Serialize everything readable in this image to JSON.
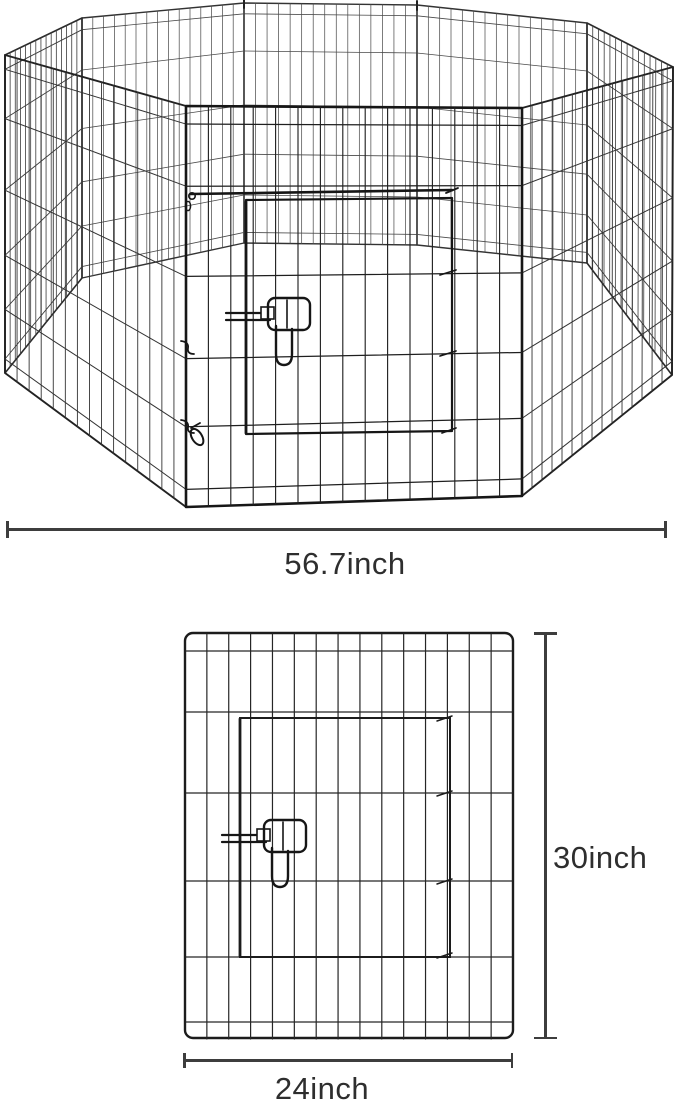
{
  "figure": {
    "kind": "product-dimension-diagram",
    "views": {
      "assembled": "octagonal-8-panel-wire-playpen-with-front-gate",
      "single_panel": "single-wire-panel-front-view-with-gate-and-latch"
    },
    "dimensions": {
      "overall_width": {
        "value": "56.7",
        "unit": "inch",
        "label": "56.7inch"
      },
      "panel_height": {
        "value": "30",
        "unit": "inch",
        "label": "30inch"
      },
      "panel_width": {
        "value": "24",
        "unit": "inch",
        "label": "24inch"
      }
    },
    "colors": {
      "wire": "#1f1f1f",
      "wire_far": "#474747",
      "dimension_line": "#3d3d3d",
      "text": "#2e2e2e",
      "background": "#ffffff"
    }
  }
}
